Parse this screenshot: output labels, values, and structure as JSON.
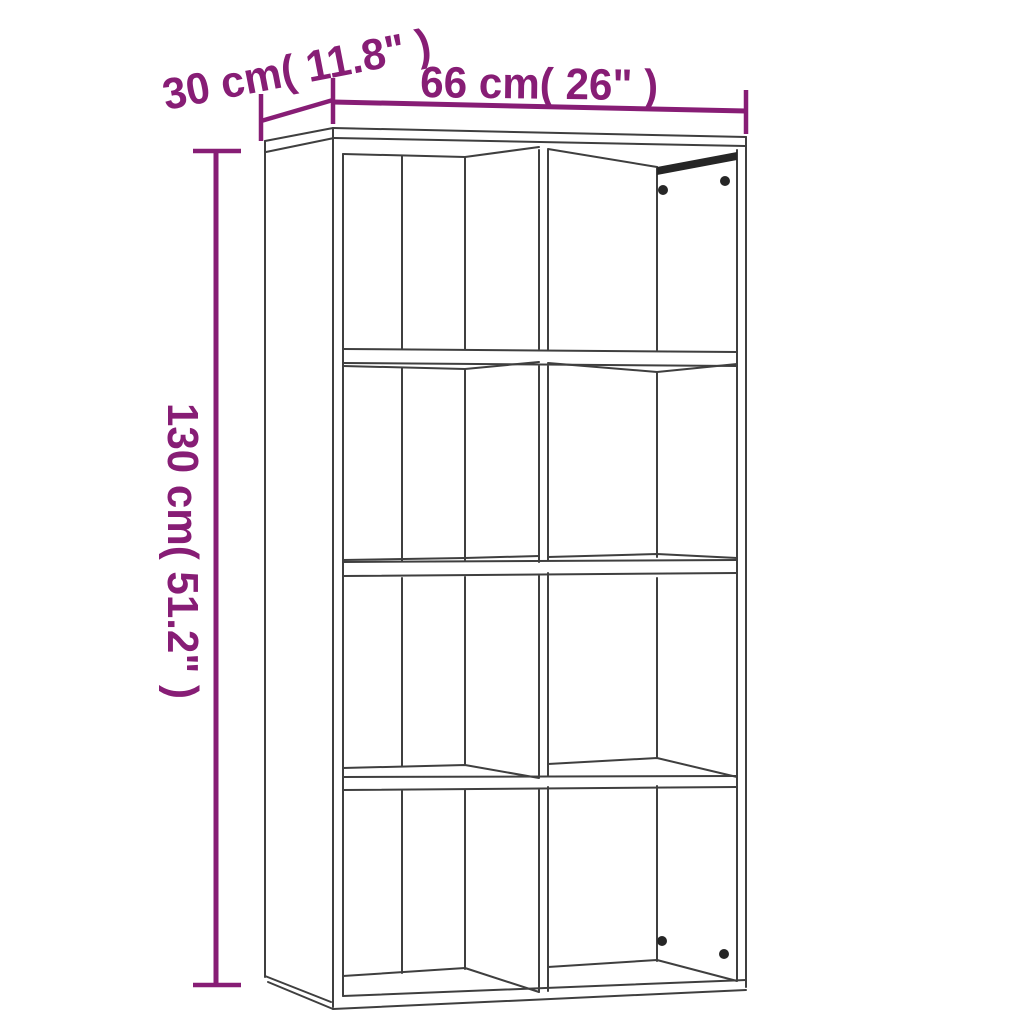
{
  "colors": {
    "accent": "#871d75",
    "outline": "#3f3f3f",
    "dark": "#262626",
    "background": "#ffffff"
  },
  "dimensions": {
    "depth": {
      "label": "30 cm( 11.8\" )",
      "cm": "30",
      "inches": "11.8"
    },
    "width": {
      "label": "66 cm( 26\" )",
      "cm": "66",
      "inches": "26"
    },
    "height": {
      "label": "130 cm( 51.2\" )",
      "cm": "130",
      "inches": "51.2"
    }
  }
}
